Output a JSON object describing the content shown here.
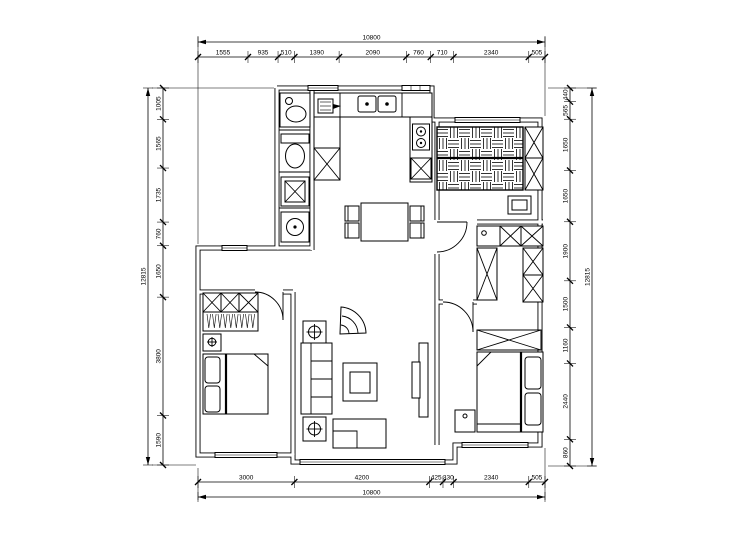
{
  "drawing": {
    "kind": "apartment-floor-plan",
    "style": "black CAD linework on white",
    "background": "#ffffff",
    "line_color": "#000000"
  },
  "dimensions": {
    "top": {
      "total": "10800",
      "segments": [
        "1555",
        "935",
        "510",
        "1390",
        "2090",
        "760",
        "710",
        "2340",
        "505"
      ]
    },
    "bottom": {
      "total": "10800",
      "segments": [
        "3000",
        "4200",
        "425",
        "330",
        "2340",
        "505"
      ]
    },
    "left": {
      "total": "12815",
      "segments": [
        "1005",
        "1565",
        "1735",
        "760",
        "1650",
        "3800",
        "1590"
      ]
    },
    "right": {
      "total": "12815",
      "segments": [
        "440",
        "565",
        "1650",
        "1650",
        "1900",
        "1500",
        "1160",
        "2440",
        "860"
      ]
    }
  },
  "symbols": {
    "master-bed": "double bed with basket-weave hatch",
    "wardrobe": "rectangle with X cross",
    "hanging-clothes": "zigzag strokes on rail",
    "dining-set": "square table with four chairs",
    "sofa": "three-seat sofa against wall",
    "coffee-table": "double rectangle",
    "tv": "slim rectangle on cabinet",
    "toilet": "tank and oval bowl",
    "washbasin": "cabinet with round basin",
    "kitchen-sink": "double basin",
    "stove": "two burner circles",
    "floor-lamp": "square with circled cross",
    "corner-plant": "fan shell sector",
    "door": "quarter-circle swing arc",
    "window": "triple line in wall"
  }
}
